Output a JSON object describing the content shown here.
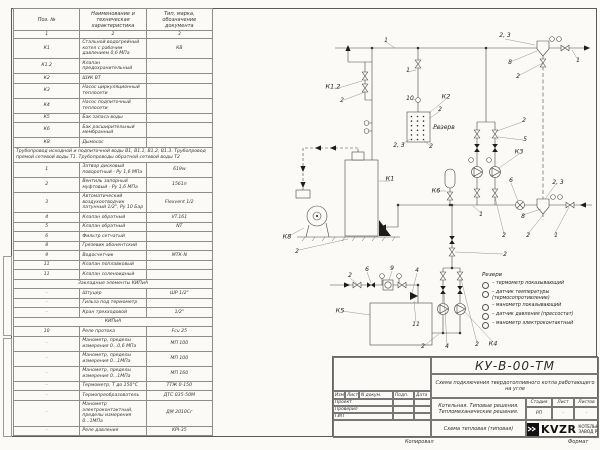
{
  "spec": {
    "headers": {
      "pos": "Поз. №",
      "name": "Наименование и техническая характеристика",
      "type": "Тип, марка, обозначение документа"
    },
    "col_numbers": [
      "1",
      "2",
      "3"
    ],
    "rows": [
      {
        "k": "row",
        "p": "К1",
        "n": "Стальной водогрейный котел с рабочим давлением 0,6 МПа",
        "t": "КВ"
      },
      {
        "k": "row",
        "p": "К1.2",
        "n": "Клапан предохранительный",
        "t": ""
      },
      {
        "k": "row",
        "p": "К2",
        "n": "ШУК ВТ",
        "t": ""
      },
      {
        "k": "row",
        "p": "К3",
        "n": "Насос циркуляционный теплосети",
        "t": ""
      },
      {
        "k": "row",
        "p": "К4",
        "n": "Насос подпиточный теплосети",
        "t": ""
      },
      {
        "k": "row",
        "p": "К5",
        "n": "Бак запаса воды",
        "t": ""
      },
      {
        "k": "row",
        "p": "К6",
        "n": "Бак расширительный мембранный",
        "t": ""
      },
      {
        "k": "row",
        "p": "К8",
        "n": "Дымосос",
        "t": ""
      },
      {
        "k": "note",
        "n": "Трубопровод исходной и подпиточной воды В1, В1.1, В1.2, В1.3. Трубопровод прямой сетевой воды Т1. Трубопроводы обратной сетевой воды Т2"
      },
      {
        "k": "row",
        "p": "1",
        "n": "Затвор дисковый поворотный - Ру 1,6 МПа",
        "t": "619w"
      },
      {
        "k": "row",
        "p": "2",
        "n": "Вентиль запорный муфтовый - Ру 1,6 МПа",
        "t": "15б1п"
      },
      {
        "k": "row",
        "p": "3",
        "n": "Автоматический воздухоотводчик латунный 1/2\", Ру 10 Бар",
        "t": "Flexvent 1/2"
      },
      {
        "k": "row",
        "p": "4",
        "n": "Клапан обратный",
        "t": "VT.161"
      },
      {
        "k": "row",
        "p": "5",
        "n": "Клапан обратный",
        "t": "NT"
      },
      {
        "k": "row",
        "p": "6",
        "n": "Фильтр сетчатый",
        "t": ""
      },
      {
        "k": "row",
        "p": "8",
        "n": "Грязевик абонентский",
        "t": ""
      },
      {
        "k": "row",
        "p": "9",
        "n": "Водосчетчик",
        "t": "МТК-N"
      },
      {
        "k": "row",
        "p": "11",
        "n": "Клапан поплавковый",
        "t": ""
      },
      {
        "k": "row",
        "p": "11",
        "n": "Клапан соленоидный",
        "t": ""
      },
      {
        "k": "sec",
        "n": "Закладные элементы КИПиА"
      },
      {
        "k": "row",
        "p": "-",
        "n": "Штуцер",
        "t": "ШР 1/2\""
      },
      {
        "k": "row",
        "p": "-",
        "n": "Гильза под термометр",
        "t": ""
      },
      {
        "k": "row",
        "p": "-",
        "n": "Кран трехходовой",
        "t": "1/2\""
      },
      {
        "k": "sec",
        "n": "КИПиА"
      },
      {
        "k": "row",
        "p": "10",
        "n": "Реле протока",
        "t": "Fcu 25"
      },
      {
        "k": "row",
        "p": "-",
        "n": "Манометр, пределы измерения 0...0,6 МПа",
        "t": "МП 100"
      },
      {
        "k": "row",
        "p": "-",
        "n": "Манометр, пределы измерения 0...1МПа",
        "t": "МП 100"
      },
      {
        "k": "row",
        "p": "-",
        "n": "Манометр, пределы измерения 0...1МПа",
        "t": "МП 160"
      },
      {
        "k": "row",
        "p": "-",
        "n": "Термометр, Т до 150°С",
        "t": "ТТЖ 0-150"
      },
      {
        "k": "row",
        "p": "-",
        "n": "Термопреобразователь",
        "t": "ДТС 035-50М"
      },
      {
        "k": "row",
        "p": "-",
        "n": "Манометр электроконтактный, пределы измерения 0...1МПа",
        "t": "ДМ 2010Сг"
      },
      {
        "k": "row",
        "p": "-",
        "n": "Реле давления",
        "t": "KPI-35"
      }
    ]
  },
  "schematic": {
    "labels": [
      {
        "t": "1",
        "x": 386,
        "y": 41
      },
      {
        "t": "2, 3",
        "x": 505,
        "y": 36
      },
      {
        "t": "8",
        "x": 510,
        "y": 63
      },
      {
        "t": "1",
        "x": 578,
        "y": 61
      },
      {
        "t": "2",
        "x": 518,
        "y": 77
      },
      {
        "t": "К1.2",
        "x": 333,
        "y": 87,
        "k": 1
      },
      {
        "t": "2",
        "x": 342,
        "y": 101
      },
      {
        "t": "1",
        "x": 408,
        "y": 71
      },
      {
        "t": "10",
        "x": 410,
        "y": 99
      },
      {
        "t": "К2",
        "x": 446,
        "y": 97,
        "k": 1
      },
      {
        "t": "2",
        "x": 440,
        "y": 110
      },
      {
        "t": "Резерв",
        "x": 444,
        "y": 128
      },
      {
        "t": "2",
        "x": 431,
        "y": 147
      },
      {
        "t": "2, 3",
        "x": 399,
        "y": 146
      },
      {
        "t": "2",
        "x": 524,
        "y": 121
      },
      {
        "t": "5",
        "x": 525,
        "y": 140
      },
      {
        "t": "К3",
        "x": 519,
        "y": 152,
        "k": 1
      },
      {
        "t": "К6",
        "x": 436,
        "y": 191,
        "k": 1
      },
      {
        "t": "6",
        "x": 511,
        "y": 181
      },
      {
        "t": "2, 3",
        "x": 558,
        "y": 183
      },
      {
        "t": "1",
        "x": 481,
        "y": 215
      },
      {
        "t": "8",
        "x": 523,
        "y": 217
      },
      {
        "t": "2",
        "x": 504,
        "y": 236
      },
      {
        "t": "2",
        "x": 528,
        "y": 236
      },
      {
        "t": "1",
        "x": 556,
        "y": 236
      },
      {
        "t": "К1",
        "x": 390,
        "y": 179,
        "k": 1
      },
      {
        "t": "К8",
        "x": 287,
        "y": 237,
        "k": 1
      },
      {
        "t": "2",
        "x": 297,
        "y": 252
      },
      {
        "t": "2",
        "x": 350,
        "y": 276
      },
      {
        "t": "6",
        "x": 367,
        "y": 270
      },
      {
        "t": "9",
        "x": 392,
        "y": 269
      },
      {
        "t": "К5",
        "x": 340,
        "y": 311,
        "k": 1
      },
      {
        "t": "4",
        "x": 417,
        "y": 271
      },
      {
        "t": "11",
        "x": 416,
        "y": 325
      },
      {
        "t": "2",
        "x": 423,
        "y": 347
      },
      {
        "t": "4",
        "x": 447,
        "y": 347
      },
      {
        "t": "2",
        "x": 477,
        "y": 345
      },
      {
        "t": "К4",
        "x": 493,
        "y": 344,
        "k": 1
      },
      {
        "t": "2",
        "x": 505,
        "y": 255
      }
    ],
    "legend": {
      "title": "Резерв",
      "items": [
        "– термометр показывающий",
        "– датчик температуры (термосопротивление)",
        "– манометр показывающий",
        "– датчик давления (прессостат)",
        "– манометр электроконтактный"
      ]
    }
  },
  "title_block": {
    "doc_number": "КУ-В-00-ТМ",
    "doc_title": "Схема подключения твердотопливного котла работающего на угле",
    "rev_headers": [
      "Изм",
      "Лист",
      "N докум.",
      "Подп.",
      "Дата"
    ],
    "rev_rows": [
      "Проект",
      "Проверил",
      "ГИП"
    ],
    "object_text": "Котельная. Типовые решения. Тепломеханические решения.",
    "stage_headers": [
      "Стадия",
      "Лист",
      "Листов"
    ],
    "stage_values": [
      "РП",
      "-",
      "-"
    ],
    "sheet_name": "Схема тепловая (типовая)",
    "logo_text": "KVZR",
    "company_line1": "КОТЕЛЬН",
    "company_line2": "ЗАВОД Р"
  },
  "footer": {
    "copied": "Копировал",
    "format": "Формат"
  }
}
